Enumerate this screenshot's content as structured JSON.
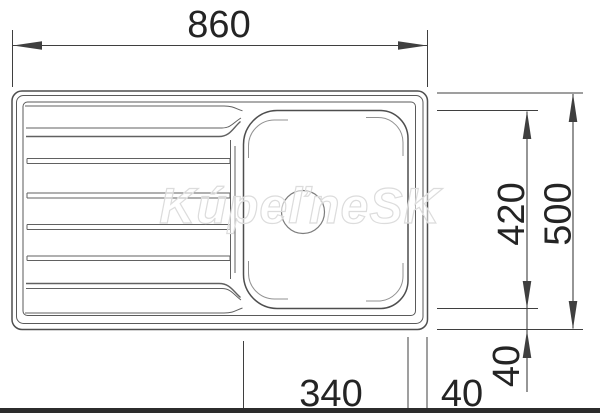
{
  "drawing": {
    "watermark": "KúpeľneSK",
    "dims": {
      "overall_width": "860",
      "overall_depth": "500",
      "bowl_length": "420",
      "bowl_width": "340",
      "bowl_bottom_offset": "40",
      "bowl_side_offset": "40"
    }
  },
  "colors": {
    "background": "#ffffff",
    "dim-line": "#3f3f3f",
    "text": "#242424",
    "sink-line": "#4e4e4e",
    "sink-line2": "#5a5a5a",
    "groove": "#616161",
    "inner": "#919191",
    "drain": "#7d7d7d",
    "bar": "#2c2c2c",
    "wm-stroke": "#dcdcdc"
  }
}
